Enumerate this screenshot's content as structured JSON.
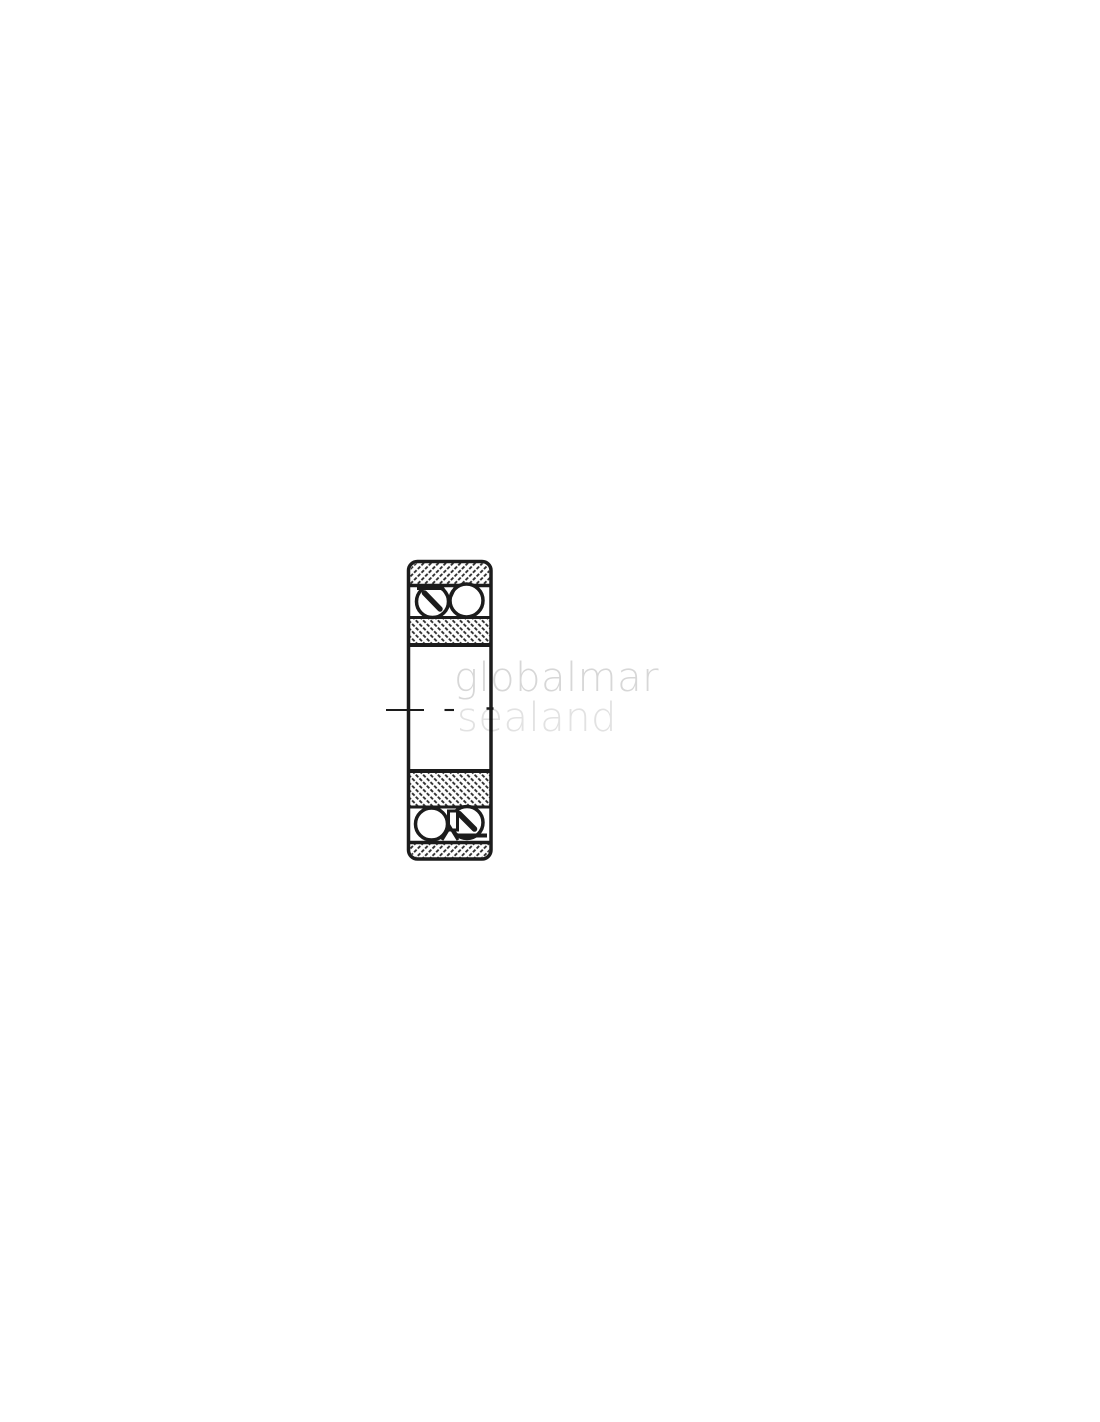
{
  "figure": {
    "label": "ball-bearing-cross-section-drawing"
  },
  "watermark": {
    "line1": "globalmar",
    "line2": "sealand"
  },
  "colors": {
    "background": "#ffffff",
    "ink": "#1c1c1c",
    "hatch": "#303030",
    "watermark_line1": "#d7d7d7",
    "watermark_line2": "#e2e2e2"
  }
}
